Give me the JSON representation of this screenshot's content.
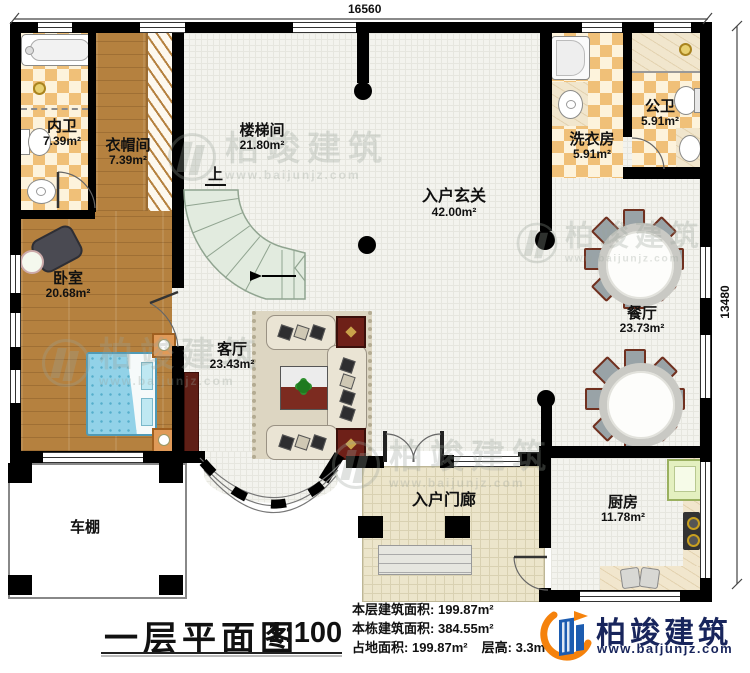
{
  "dimensions": {
    "top": "16560",
    "right": "13480"
  },
  "rooms": {
    "neiwei": {
      "name": "内卫",
      "area": "7.39m²"
    },
    "yimaojian": {
      "name": "衣帽间",
      "area": "7.39m²"
    },
    "loutijian": {
      "name": "楼梯间",
      "area": "21.80m²"
    },
    "xuanguan": {
      "name": "入户玄关",
      "area": "42.00m²"
    },
    "xiyifang": {
      "name": "洗衣房",
      "area": "5.91m²"
    },
    "gongwei": {
      "name": "公卫",
      "area": "5.91m²"
    },
    "woshi": {
      "name": "卧室",
      "area": "20.68m²"
    },
    "keting": {
      "name": "客厅",
      "area": "23.43m²"
    },
    "canting": {
      "name": "餐厅",
      "area": "23.73m²"
    },
    "chufang": {
      "name": "厨房",
      "area": "11.78m²"
    },
    "menlang": {
      "name": "入户门廊"
    },
    "chepeng": {
      "name": "车棚"
    }
  },
  "stairs": {
    "up_label": "上"
  },
  "title_block": {
    "title": "一层平面图",
    "scale": "1:100"
  },
  "stats": {
    "floor_area_label": "本层建筑面积:",
    "floor_area_value": "199.87m²",
    "building_area_label": "本栋建筑面积:",
    "building_area_value": "384.55m²",
    "footprint_label": "占地面积:",
    "footprint_value": "199.87m²",
    "height_label": "层高:",
    "height_value": "3.3m"
  },
  "logo": {
    "company": "柏竣建筑",
    "website": "www.baijunjz.com"
  },
  "watermark": {
    "text": "柏竣建筑",
    "subtext": "www.baijunjz.com"
  },
  "colors": {
    "wall": "#000000",
    "wood_floor": "#b5813f",
    "tile_checker": "#f0c078",
    "stair": "#e2ebdf",
    "bed": "#92d2e8",
    "table_red": "#7c2b20",
    "brand_navy": "#18255c",
    "brand_orange": "#f5820c",
    "brand_blue": "#1c5cb0"
  }
}
